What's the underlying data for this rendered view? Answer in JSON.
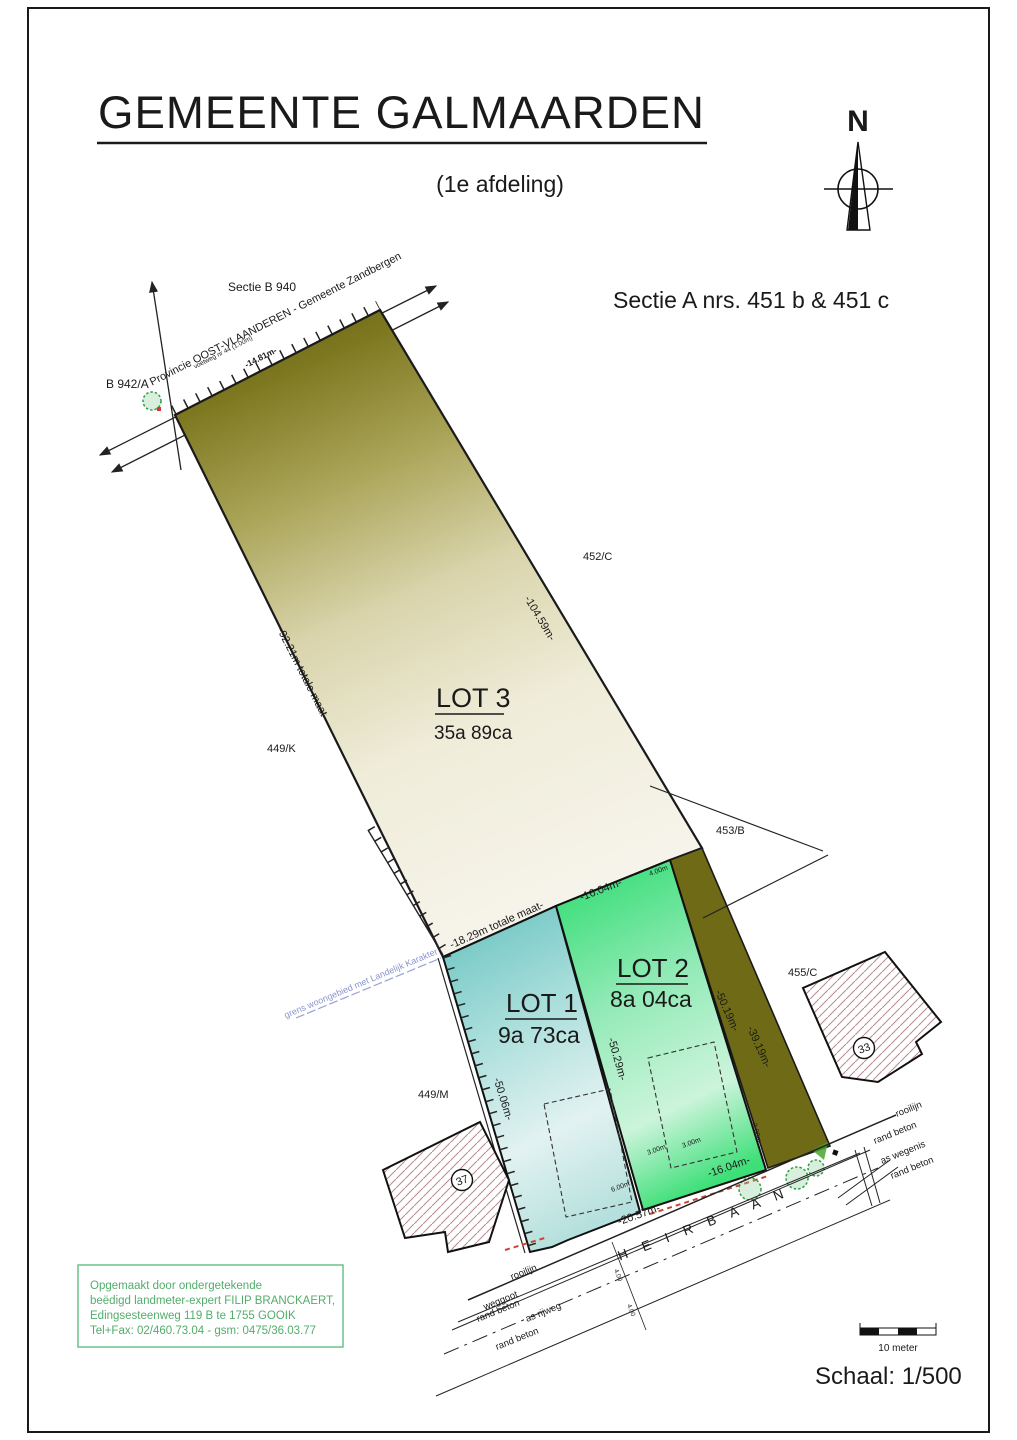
{
  "title": "GEMEENTE GALMAARDEN",
  "subtitle": "(1e afdeling)",
  "section_title": "Sectie A nrs. 451 b & 451 c",
  "north": {
    "label": "N"
  },
  "parcel_labels": {
    "sectie_b940": "Sectie B 940",
    "b942a": "B 942/A",
    "provincie": "Provincie OOST-VLAANDEREN - Gemeente Zandbergen",
    "p452c": "452/C",
    "p449k": "449/K",
    "p453b": "453/B",
    "p455c": "455/C",
    "p449m": "449/M"
  },
  "path_note": "voetweg nr 44 (1.00m)",
  "boundary_note": "grens woongebied met Landelijk Karakter",
  "lots": {
    "lot3": {
      "name": "LOT 3",
      "area": "35a 89ca"
    },
    "lot1": {
      "name": "LOT 1",
      "area": "9a 73ca"
    },
    "lot2": {
      "name": "LOT 2",
      "area": "8a 04ca"
    }
  },
  "measurements": {
    "top_edge": "-14.81m-",
    "right_upper": "-104.59m-",
    "left_total": "-92.21m totale maat-",
    "lot1_top": "-18.29m totale maat-",
    "lot2_top": "-16.04m-",
    "divider": "-50.29m-",
    "lot1_left": "-50.06m-",
    "strip_left": "-50.19m-",
    "strip_right": "-39.19m-",
    "lot1_bottom": "-20.57m-",
    "lot2_bottom": "-16.04m-"
  },
  "dims": {
    "a": "4.00m",
    "b": "3.00m",
    "c": "3.00m",
    "d": "6.00m",
    "e": "3.00m",
    "f": "4.00",
    "g": "4.00"
  },
  "buildings": {
    "b37": "37",
    "b33": "33"
  },
  "road": {
    "name": "H E I R B A A N",
    "labels_left": [
      "rooilijn",
      "weggoot",
      "rand beton",
      "as rijweg",
      "rand beton"
    ],
    "labels_right": [
      "rooilijn",
      "rand beton",
      "as wegenis",
      "rand beton"
    ]
  },
  "surveyor_box": {
    "line1": "Opgemaakt door ondergetekende",
    "line2": "beëdigd landmeter-expert FILIP BRANCKAERT,",
    "line3": "Edingsesteenweg 119 B te 1755 GOOIK",
    "line4": "Tel+Fax: 02/460.73.04 - gsm: 0475/36.03.77"
  },
  "scale": {
    "text": "Schaal: 1/500",
    "bar_label": "10 meter"
  },
  "colors": {
    "red_dim": "#e62129",
    "olive_label": "#b3a035",
    "blue_note": "#8a93cd",
    "green_box": "#52ad6b",
    "lot1_fill": "#7fccc9",
    "lot2_fill": "#3fe07b",
    "lot3_fill": "#6e6a15",
    "hatch": "#b98f92"
  }
}
